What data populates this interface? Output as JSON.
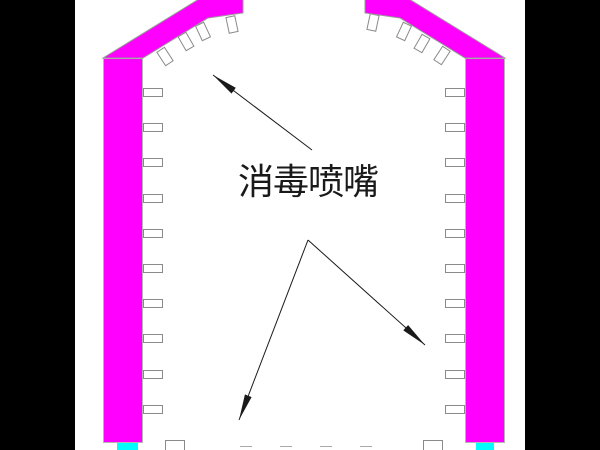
{
  "title": "disinfection-channel-cross-section",
  "label": {
    "text": "消毒喷嘴"
  },
  "colors": {
    "wall": "#ff00ff",
    "pad": "#00ffff",
    "letterbox": "#000000",
    "canvas": "#ffffff",
    "arrow": "#1a1a1a",
    "text": "#1a1a1a"
  },
  "nozzles": {
    "left_wall_count": 10,
    "right_wall_count": 10,
    "left_roof_count": 4,
    "right_roof_count": 4
  }
}
